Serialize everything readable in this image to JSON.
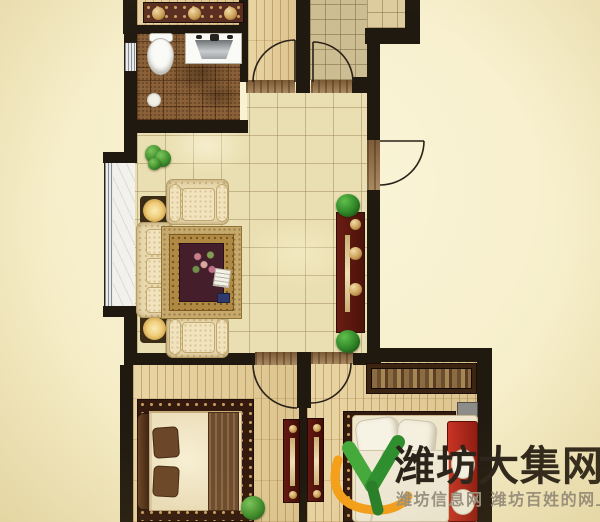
{
  "watermark": {
    "brand": "潍坊大集网",
    "slogan": "潍坊信息网 潍坊百姓的网上大集"
  },
  "palette": {
    "background": "#F7EFCB",
    "wall": "#201910",
    "marble_tile": "#EADFB2",
    "wood_floor": "#E2CC98",
    "bathroom_tile": "#8A6138",
    "kitchen_tile": "#CDBD92",
    "console_red": "#5E1710",
    "bed_blanket_red": "#B3261C",
    "plant_green": "#4C9A38",
    "logo_green": "#3BA43C",
    "logo_orange": "#F4A01B",
    "rug_gold": "#C6A96B",
    "rug_maroon": "#451E2B"
  },
  "rooms": [
    {
      "name": "balcony"
    },
    {
      "name": "bathroom"
    },
    {
      "name": "corridor"
    },
    {
      "name": "kitchen"
    },
    {
      "name": "living-room"
    },
    {
      "name": "hallway"
    },
    {
      "name": "bedroom-1"
    },
    {
      "name": "bedroom-2"
    }
  ]
}
